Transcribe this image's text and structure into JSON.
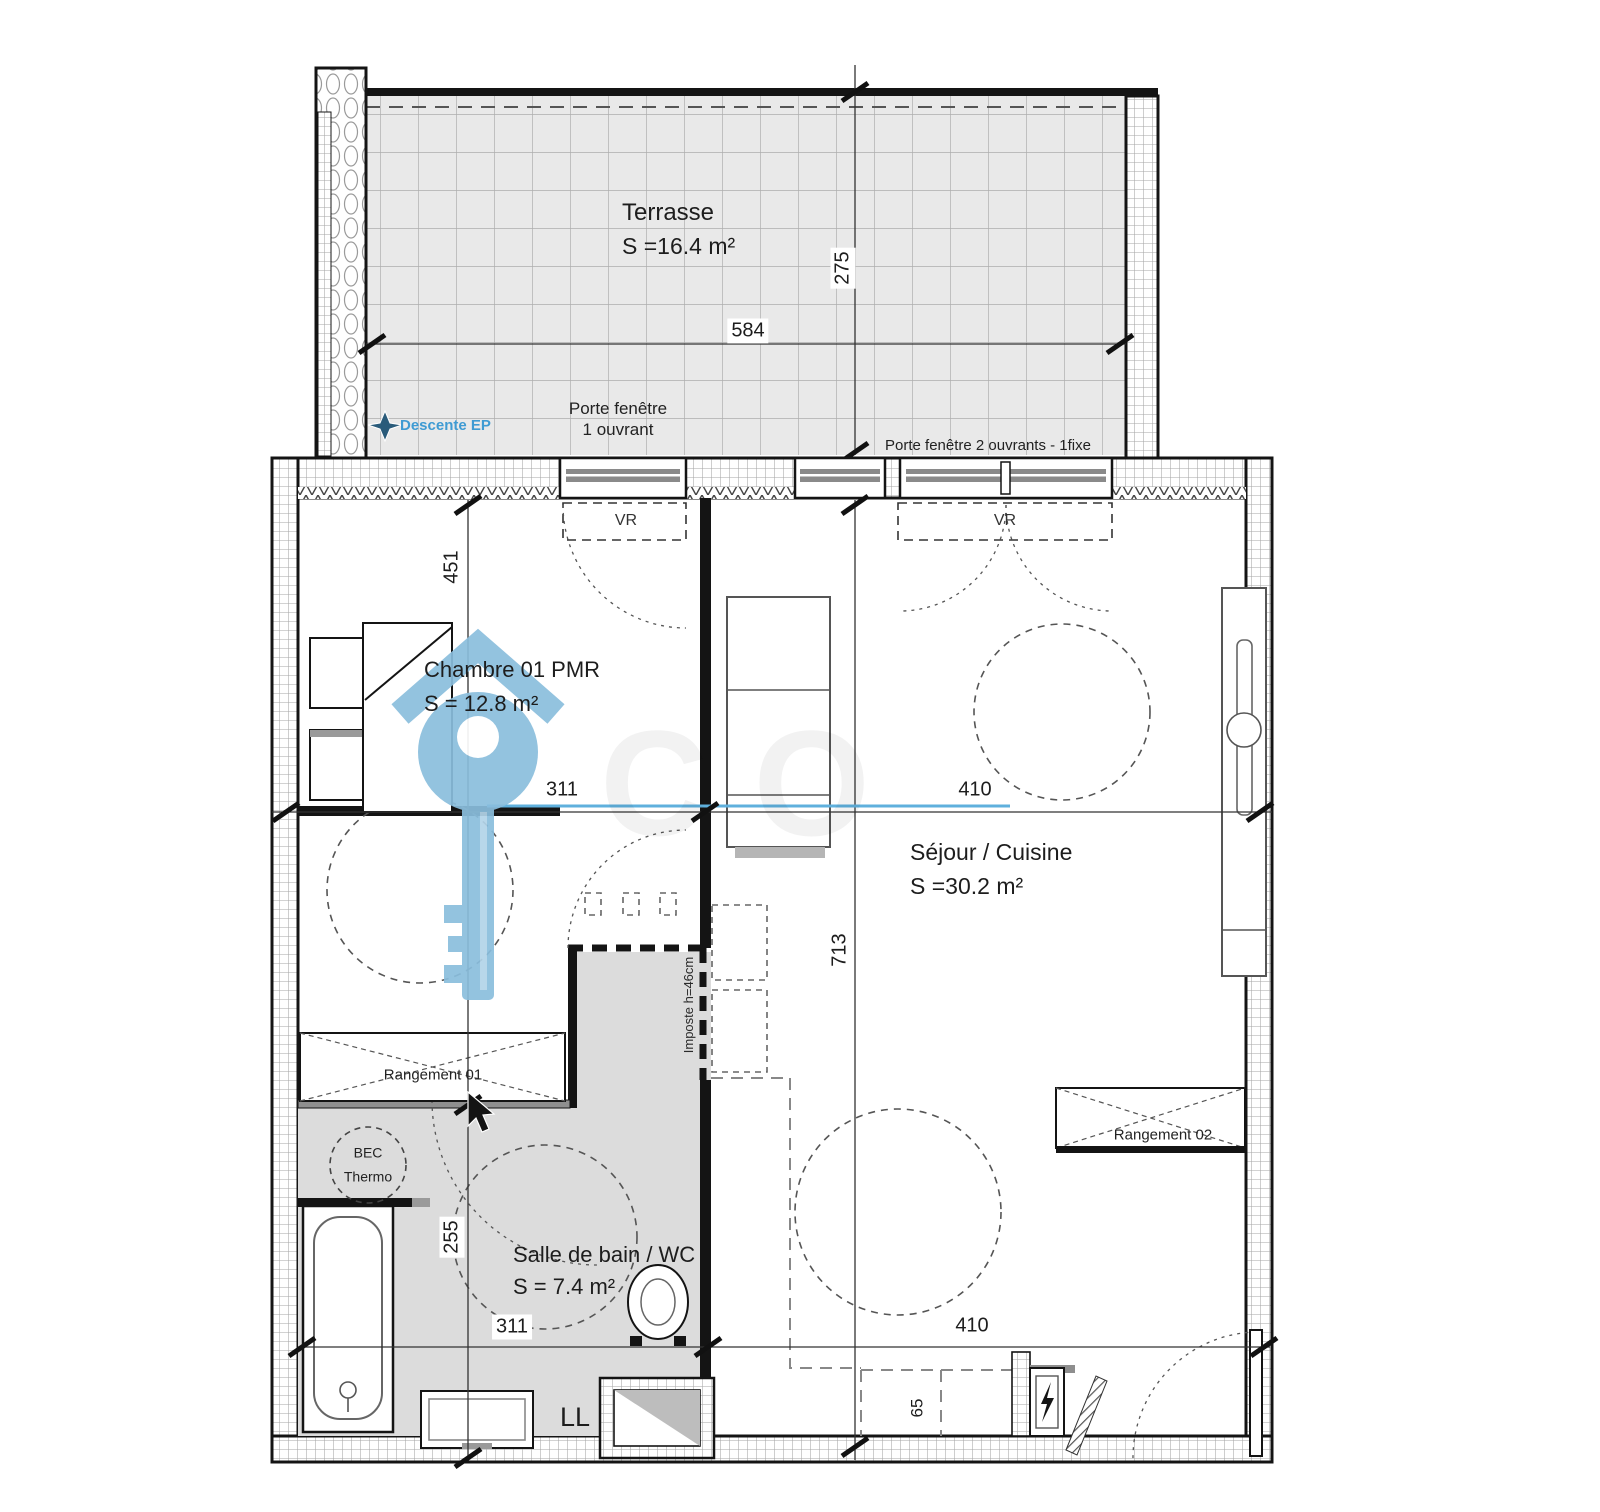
{
  "rooms": {
    "terrasse": {
      "name": "Terrasse",
      "area": "S =16.4 m²"
    },
    "chambre": {
      "name": "Chambre 01 PMR",
      "area": "S = 12.8 m²"
    },
    "sejour": {
      "name": "Séjour / Cuisine",
      "area": "S =30.2 m²"
    },
    "sdb": {
      "name": "Salle de bain / WC",
      "area": "S = 7.4 m²"
    }
  },
  "dims": {
    "terrace_width": "584",
    "terrace_depth": "275",
    "chambre_depth": "451",
    "chambre_width": "311",
    "sejour_width": "410",
    "sejour_depth": "713",
    "bath_depth": "255",
    "bath_width": "311",
    "bottom_width": "410",
    "counter_depth": "65"
  },
  "openings": {
    "pf1_line1": "Porte fenêtre",
    "pf1_line2": "1 ouvrant",
    "pf2": "Porte fenêtre 2 ouvrants - 1fixe",
    "vr_left": "VR",
    "vr_right": "VR"
  },
  "fixtures": {
    "rangement01": "Rangement 01",
    "rangement02": "Rangement 02",
    "bec_line1": "BEC",
    "bec_line2": "Thermo",
    "washing_machine": "LL",
    "imposte": "Imposte h=46cm"
  },
  "watermark": {
    "descente_label": "Descente EP",
    "ghost": "CO"
  },
  "colors": {
    "watermark_blue": "#8abedd",
    "line_blue": "#5fb0dd",
    "text_blue": "#3f9bd3",
    "terrace_fill": "#e9e9e9",
    "bath_fill": "#dcdcdc",
    "wall_line": "#141414"
  }
}
